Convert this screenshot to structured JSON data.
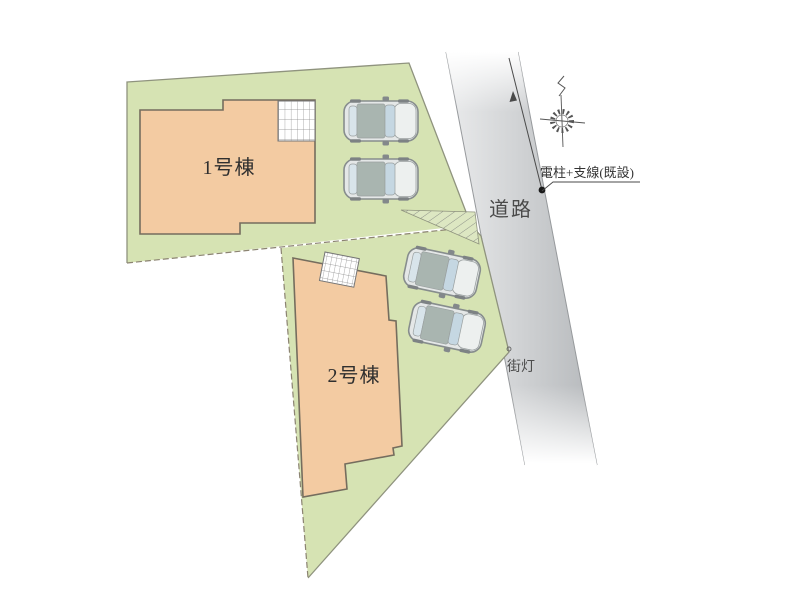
{
  "labels": {
    "building_1": "1号棟",
    "building_2": "2号棟",
    "road": "道路",
    "street_light": "街灯",
    "utility_pole": "電柱+支線(既設)"
  },
  "colors": {
    "land": "#d6e3b3",
    "land_outline": "#8f937e",
    "boundary_dash": "#8b8371",
    "building": "#f3cba2",
    "building_outline": "#756d5e",
    "road_light": "#eaebec",
    "road_dark": "#b4b7ba",
    "car_body": "#e4e7e7",
    "car_roof": "#a9b5b0",
    "car_glass": "#c5d7e2",
    "annotation": "#333333"
  },
  "objects": {
    "building_count": 2,
    "car_count": 4,
    "balcony_count": 2
  }
}
